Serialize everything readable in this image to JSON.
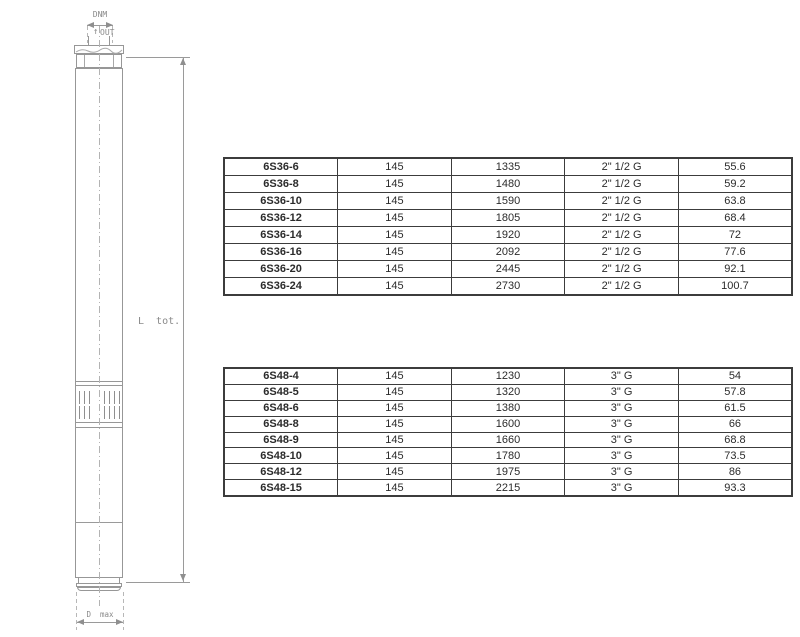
{
  "diagram": {
    "labels": {
      "dnm": "DNM",
      "out": "OUT",
      "out_arrow": "↑",
      "l_tot": "L  tot.",
      "d_max": "D  max"
    },
    "parts": [
      "outlet-pipe",
      "discharge-head",
      "pump-body",
      "suction-strainer",
      "motor-section",
      "motor-base"
    ]
  },
  "tables": {
    "t36": {
      "rows": [
        [
          "6S36-6",
          "145",
          "1335",
          "2\" 1/2 G",
          "55.6"
        ],
        [
          "6S36-8",
          "145",
          "1480",
          "2\" 1/2 G",
          "59.2"
        ],
        [
          "6S36-10",
          "145",
          "1590",
          "2\" 1/2 G",
          "63.8"
        ],
        [
          "6S36-12",
          "145",
          "1805",
          "2\" 1/2 G",
          "68.4"
        ],
        [
          "6S36-14",
          "145",
          "1920",
          "2\" 1/2 G",
          "72"
        ],
        [
          "6S36-16",
          "145",
          "2092",
          "2\" 1/2 G",
          "77.6"
        ],
        [
          "6S36-20",
          "145",
          "2445",
          "2\" 1/2 G",
          "92.1"
        ],
        [
          "6S36-24",
          "145",
          "2730",
          "2\" 1/2 G",
          "100.7"
        ]
      ]
    },
    "t48": {
      "rows": [
        [
          "6S48-4",
          "145",
          "1230",
          "3\" G",
          "54"
        ],
        [
          "6S48-5",
          "145",
          "1320",
          "3\" G",
          "57.8"
        ],
        [
          "6S48-6",
          "145",
          "1380",
          "3\" G",
          "61.5"
        ],
        [
          "6S48-8",
          "145",
          "1600",
          "3\" G",
          "66"
        ],
        [
          "6S48-9",
          "145",
          "1660",
          "3\" G",
          "68.8"
        ],
        [
          "6S48-10",
          "145",
          "1780",
          "3\" G",
          "73.5"
        ],
        [
          "6S48-12",
          "145",
          "1975",
          "3\" G",
          "86"
        ],
        [
          "6S48-15",
          "145",
          "2215",
          "3\" G",
          "93.3"
        ]
      ]
    }
  },
  "colors": {
    "background": "#ffffff",
    "drawing_line": "#979797",
    "drawing_label": "#8a8a8a",
    "table_border": "#3c3c3c",
    "table_text": "#2b2b2b"
  }
}
